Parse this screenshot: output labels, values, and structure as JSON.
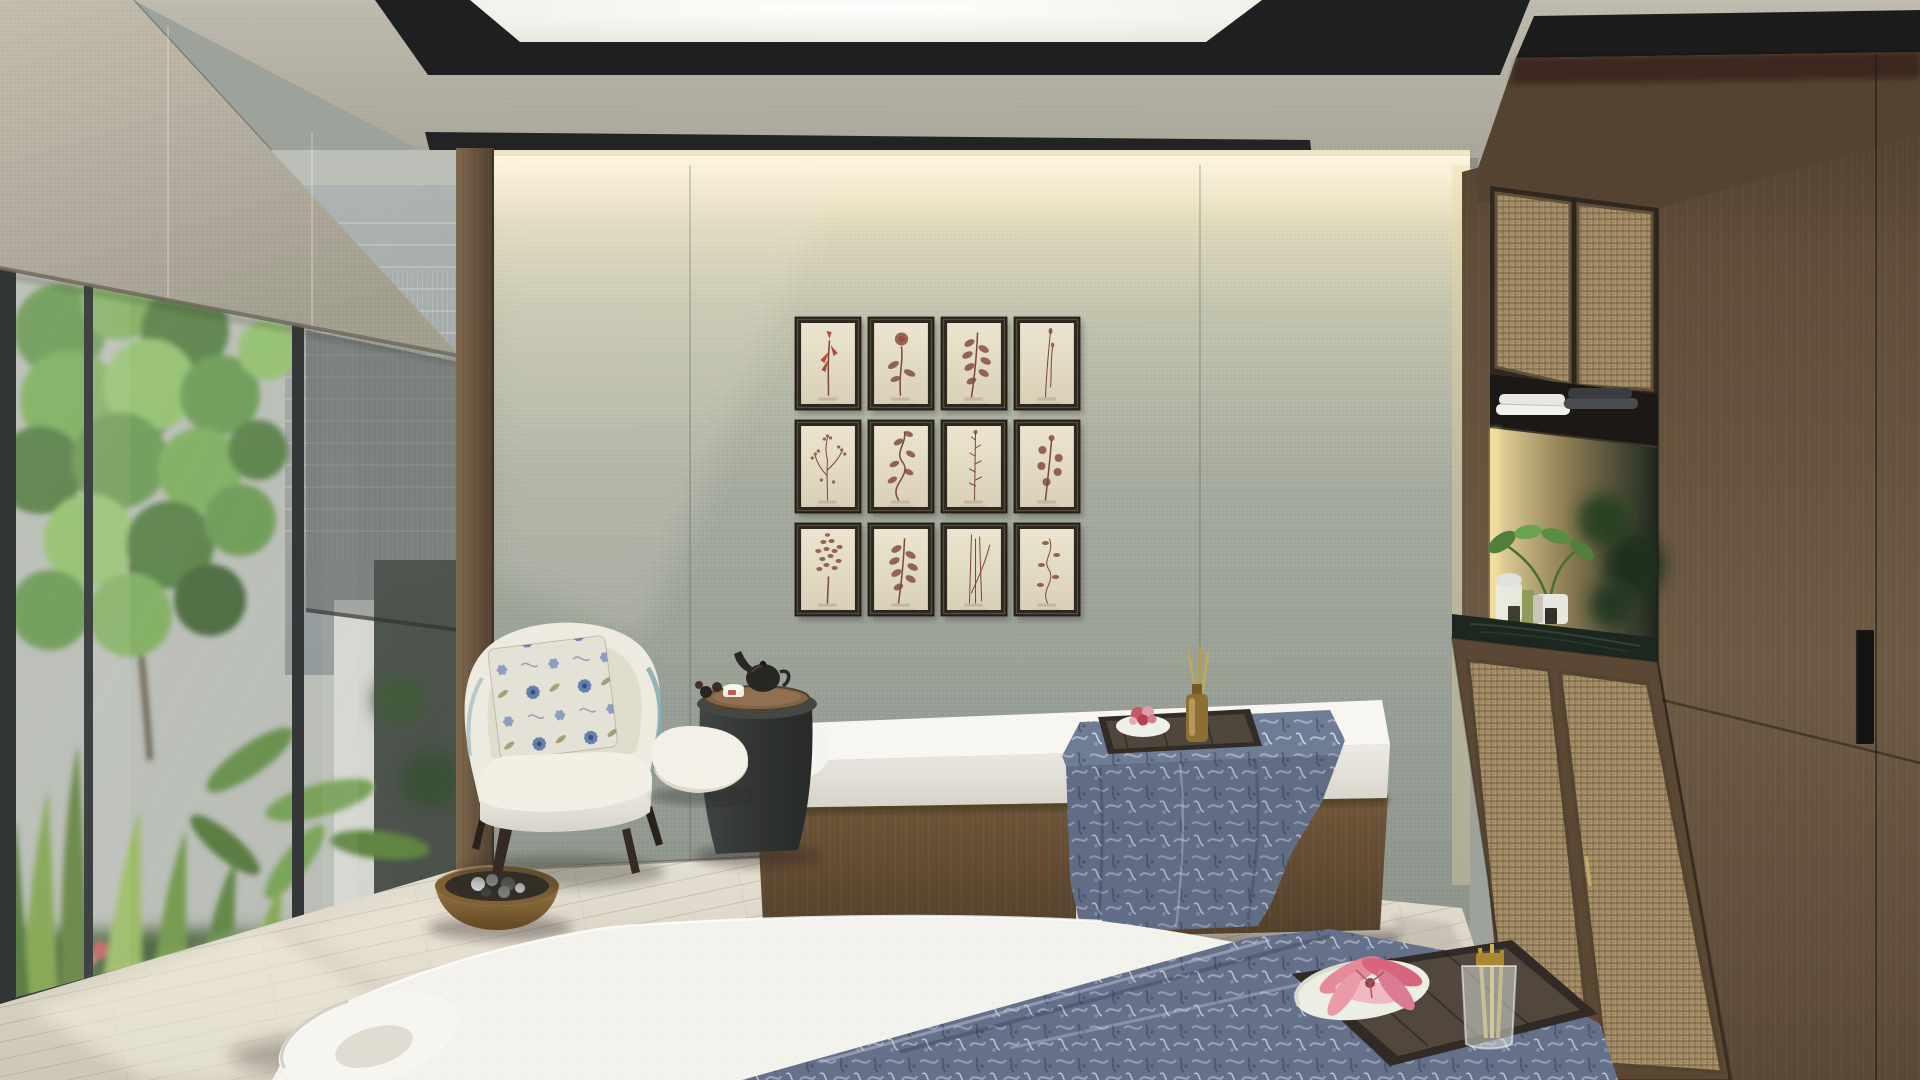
{
  "scene": {
    "type": "interior-render",
    "description": "Photorealistic rendering of a luxury spa couples treatment room with garden window",
    "room": "spa treatment room",
    "lighting": "daylight from floor-to-ceiling garden window with warm cove lighting washing a textured fabric wall",
    "objects": [
      "stepped acoustic ceiling with recessed skylight",
      "gallery wall of twelve framed pressed-botanical prints",
      "floor-to-ceiling window with garden and tree view",
      "linen roller shade partially lowered",
      "cream curved lounge armchair with blue floral cushion",
      "charcoal pedestal side table with tea tray and teapot",
      "two massage treatment beds with wood bases",
      "blue patterned silk runners draped on beds",
      "dark wood amenity trays with flower dish and oil diffuser",
      "rattan-front cabinetry with towel shelf and lit vanity niche",
      "green marble counter with plant, jar and oils",
      "wooden bowl with river stones on the floor",
      "whitewashed oak plank floor"
    ]
  },
  "palette": {
    "ceiling_concrete": "#b6b3a7",
    "ceiling_recess": "#17181a",
    "skylight": "#f6f5f0",
    "wall_top_glow": "#efe6c9",
    "wall_mid": "#9da397",
    "shade_fabric": "#b7b2a3",
    "window_frame": "#2e3132",
    "foliage_green": "#6f9c4d",
    "wood_trim": "#6b5640",
    "bed_base_wood": "#63492f",
    "mattress_white": "#f3f2ee",
    "runner_blue": "#6b7894",
    "chair_cream": "#edebdf",
    "chair_piping_teal": "#7fa8b0",
    "tray_wood_dark": "#2c2521",
    "flower_pink": "#e48898",
    "diffuser_amber": "#8a6b2f",
    "cane_rattan": "#a28a63",
    "marble_counter": "#152219",
    "floor_oak": "#dcd6c8"
  },
  "artwork_grid": {
    "rows": 3,
    "cols": 4,
    "origin_x": 795,
    "origin_y": 317,
    "frame_width": 66,
    "frame_height": 93,
    "gap_x": 7,
    "gap_y": 10,
    "frame_color": "#262019",
    "paper_color": "#e8e0cb",
    "ink_color": "#7a4334",
    "accent_color": "#a3402c",
    "items": [
      {
        "id": 1,
        "type": "heliconia"
      },
      {
        "id": 2,
        "type": "rose"
      },
      {
        "id": 3,
        "type": "leaf-cluster"
      },
      {
        "id": 4,
        "type": "thin-stem"
      },
      {
        "id": 5,
        "type": "sprig"
      },
      {
        "id": 6,
        "type": "vine"
      },
      {
        "id": 7,
        "type": "tall-herb"
      },
      {
        "id": 8,
        "type": "round-leaf"
      },
      {
        "id": 9,
        "type": "bushy-twig"
      },
      {
        "id": 10,
        "type": "leaf-cluster"
      },
      {
        "id": 11,
        "type": "reeds"
      },
      {
        "id": 12,
        "type": "sparse-vine"
      }
    ]
  },
  "window": {
    "panes": 3,
    "mullion_color": "#2e3132",
    "shade_color": "#b7b2a3",
    "view": "garden with tree, tall grasses, large tropical leaves and a neighbouring grey building"
  },
  "beds": {
    "count": 2,
    "mattress_color": "#f3f2ee",
    "base_wood": "#63492f",
    "runner_color": "#6b7894",
    "tray_items": [
      "ceramic dish with pink lily",
      "reed oil diffuser bottle"
    ]
  },
  "cabinetry": {
    "upper": "two cane-front cabinet doors",
    "shelf": [
      "white folded towels",
      "charcoal folded towels"
    ],
    "niche": "warm-lit vanity niche with mirror reflecting garden greenery",
    "counter_items": [
      "glass jar",
      "green oil bottle",
      "amber bottle",
      "two dark boxes",
      "potted plant"
    ],
    "lower": "two cane-front cabinet doors with brass pull",
    "wardrobe": "full-height smoked oak panels with recessed black pull"
  },
  "side_table": {
    "items": [
      "wood tray",
      "black teapot",
      "white tea cup with red motif",
      "chocolate truffles"
    ]
  }
}
